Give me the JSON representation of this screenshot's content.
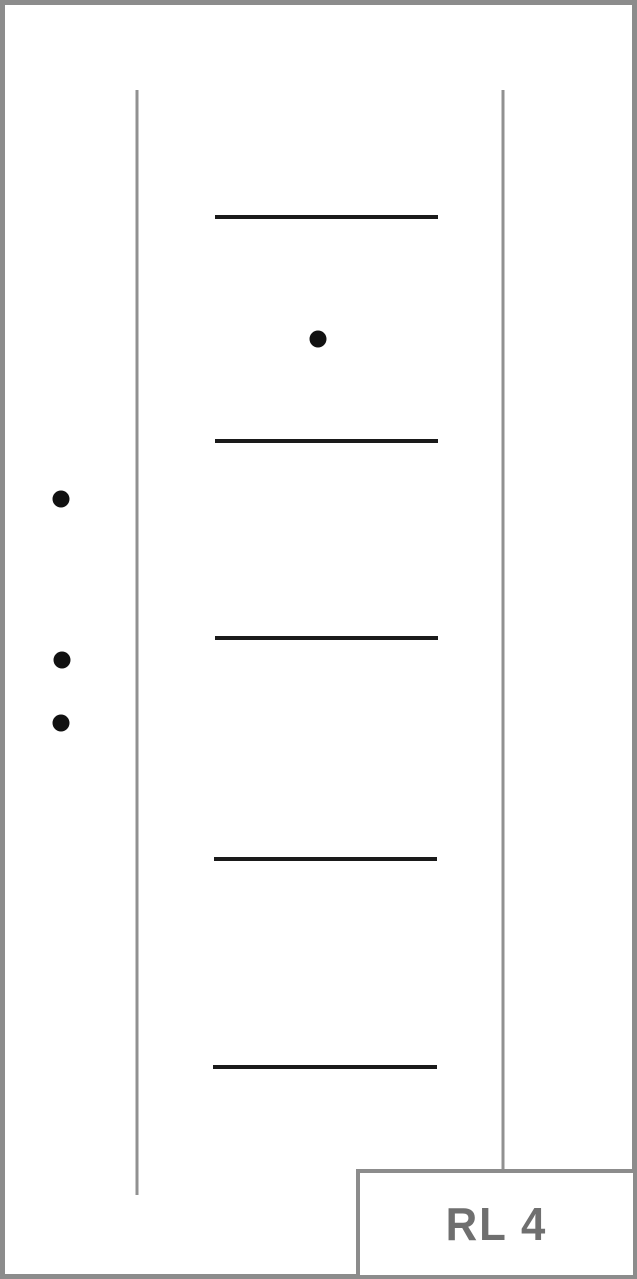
{
  "diagram": {
    "colors": {
      "background": "#ffffff",
      "frame_border": "#8c8c8c",
      "rail_line": "#919191",
      "groove_line": "#1a1a1a",
      "dot": "#111111"
    },
    "vertical_lines": [
      {
        "x": 137,
        "y1": 90,
        "y2": 1195,
        "width": 3
      },
      {
        "x": 503,
        "y1": 90,
        "y2": 1172,
        "width": 3
      }
    ],
    "horizontal_lines": [
      {
        "x1": 215,
        "x2": 438,
        "y": 217,
        "width": 4
      },
      {
        "x1": 215,
        "x2": 438,
        "y": 441,
        "width": 4
      },
      {
        "x1": 215,
        "x2": 438,
        "y": 638,
        "width": 4
      },
      {
        "x1": 214,
        "x2": 437,
        "y": 859,
        "width": 4
      },
      {
        "x1": 213,
        "x2": 437,
        "y": 1067,
        "width": 4
      }
    ],
    "dots": [
      {
        "cx": 318,
        "cy": 339,
        "r": 8.5
      },
      {
        "cx": 61,
        "cy": 499,
        "r": 8.5
      },
      {
        "cx": 62,
        "cy": 660,
        "r": 8.5
      },
      {
        "cx": 61,
        "cy": 723,
        "r": 8.5
      }
    ]
  },
  "label_box": {
    "text": "RL 4",
    "text_color": "#6f6f6f",
    "border_color": "#8c8c8c"
  }
}
